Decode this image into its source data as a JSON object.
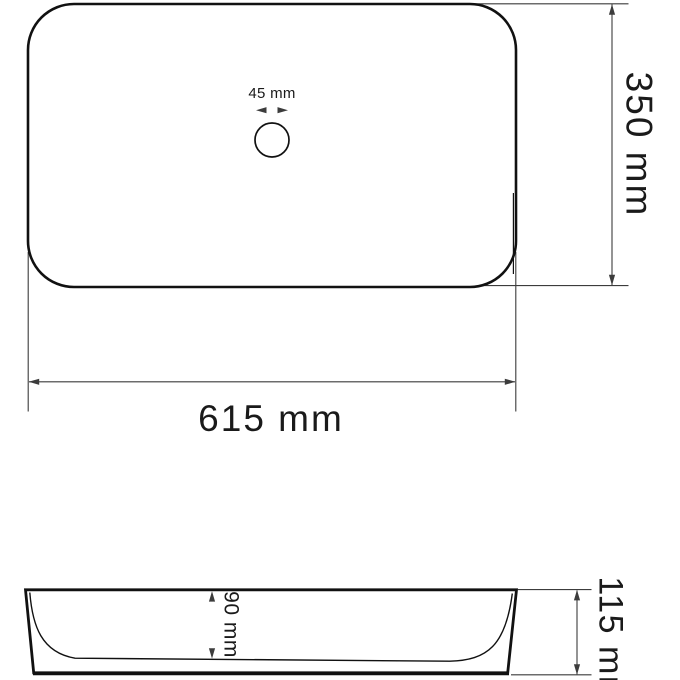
{
  "drawing": {
    "colors": {
      "background": "#ffffff",
      "outline": "#111111",
      "dimension_lines": "#3c3c3c",
      "text": "#1a1a1a"
    },
    "dimensions": {
      "drain_diameter": {
        "label": "45 mm"
      },
      "top_view_depth": {
        "label": "350 mm"
      },
      "basin_width": {
        "label": "615 mm"
      },
      "inner_depth": {
        "label": "90 mm"
      },
      "total_height": {
        "label": "115 mm"
      }
    }
  }
}
